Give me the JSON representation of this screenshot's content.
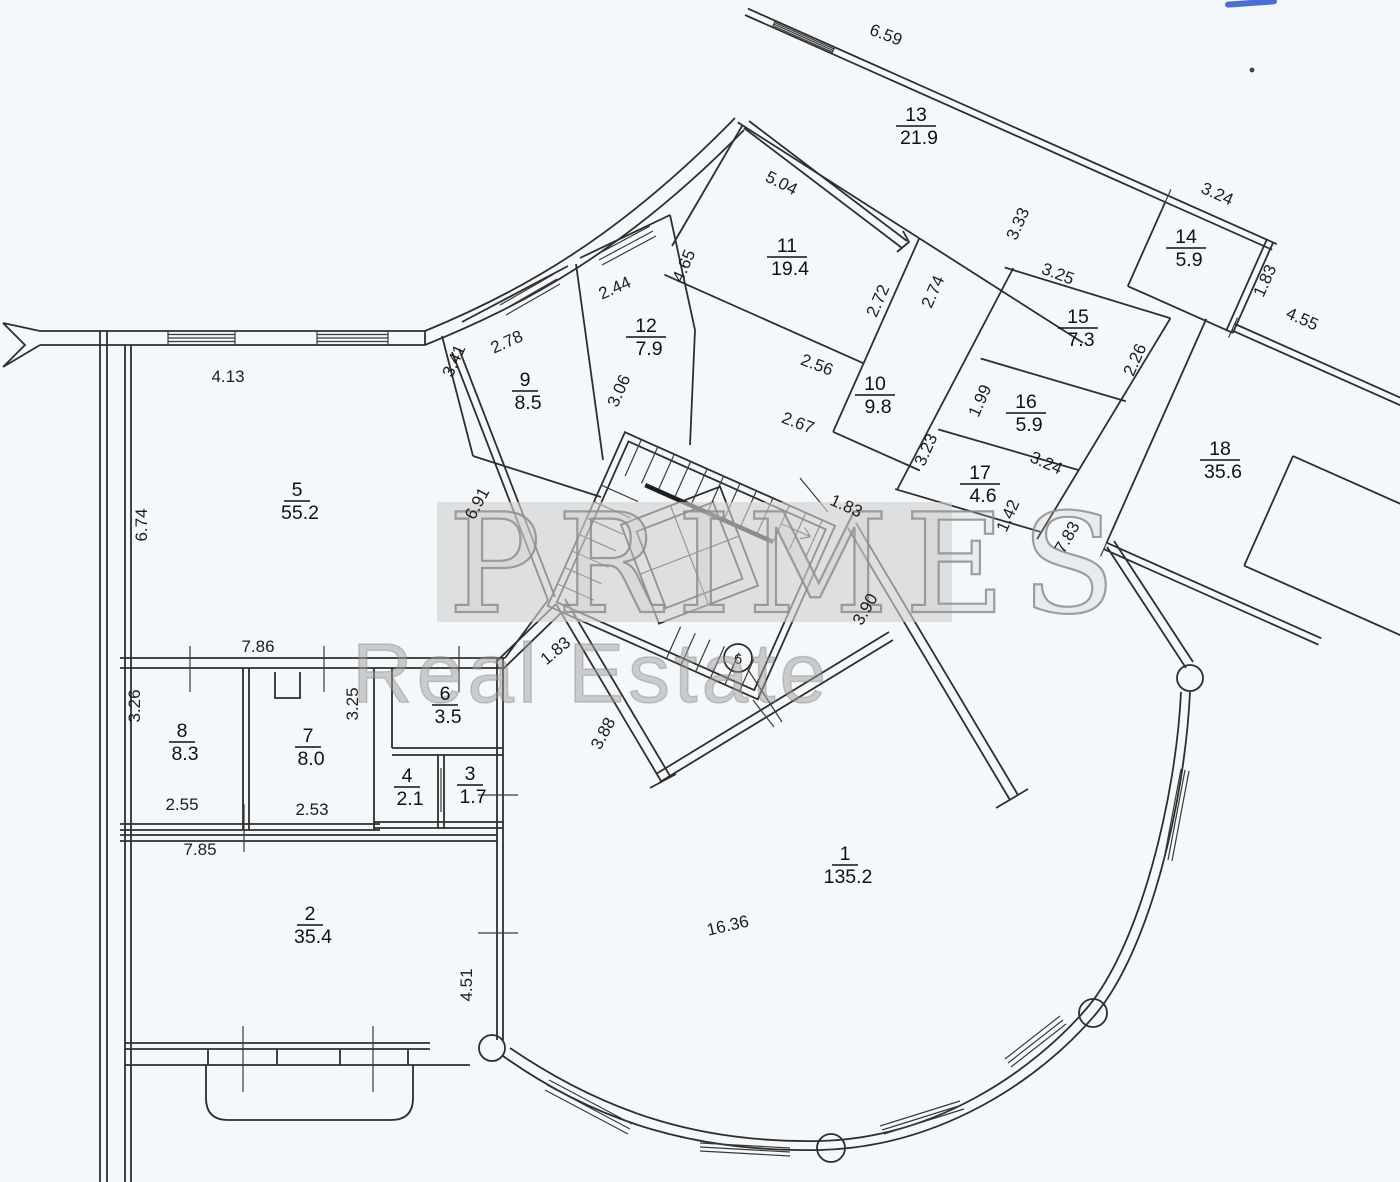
{
  "watermark": {
    "line1": "PRIMES",
    "line2": "Real Estate"
  },
  "column_marker": "6",
  "rooms": [
    {
      "number": "1",
      "area": "135.2",
      "x": 845,
      "y": 860
    },
    {
      "number": "2",
      "area": "35.4",
      "x": 310,
      "y": 920
    },
    {
      "number": "3",
      "area": "1.7",
      "x": 470,
      "y": 780
    },
    {
      "number": "4",
      "area": "2.1",
      "x": 407,
      "y": 782
    },
    {
      "number": "5",
      "area": "55.2",
      "x": 297,
      "y": 496
    },
    {
      "number": "6",
      "area": "3.5",
      "x": 445,
      "y": 700
    },
    {
      "number": "7",
      "area": "8.0",
      "x": 308,
      "y": 742
    },
    {
      "number": "8",
      "area": "8.3",
      "x": 182,
      "y": 737
    },
    {
      "number": "9",
      "area": "8.5",
      "x": 525,
      "y": 386
    },
    {
      "number": "10",
      "area": "9.8",
      "x": 875,
      "y": 390
    },
    {
      "number": "11",
      "area": "19.4",
      "x": 787,
      "y": 252
    },
    {
      "number": "12",
      "area": "7.9",
      "x": 646,
      "y": 332
    },
    {
      "number": "13",
      "area": "21.9",
      "x": 916,
      "y": 121
    },
    {
      "number": "14",
      "area": "5.9",
      "x": 1186,
      "y": 243
    },
    {
      "number": "15",
      "area": "7.3",
      "x": 1078,
      "y": 323
    },
    {
      "number": "16",
      "area": "5.9",
      "x": 1026,
      "y": 408
    },
    {
      "number": "17",
      "area": "4.6",
      "x": 980,
      "y": 479
    },
    {
      "number": "18",
      "area": "35.6",
      "x": 1220,
      "y": 455
    }
  ],
  "dimensions": [
    {
      "text": "4.13",
      "x": 228,
      "y": 382,
      "rot": 0
    },
    {
      "text": "6.74",
      "x": 147,
      "y": 525,
      "rot": -90
    },
    {
      "text": "7.86",
      "x": 258,
      "y": 652,
      "rot": 0
    },
    {
      "text": "3.26",
      "x": 140,
      "y": 706,
      "rot": -90
    },
    {
      "text": "2.55",
      "x": 182,
      "y": 810,
      "rot": 0
    },
    {
      "text": "3.25",
      "x": 358,
      "y": 704,
      "rot": -90
    },
    {
      "text": "2.53",
      "x": 312,
      "y": 815,
      "rot": 0
    },
    {
      "text": "7.85",
      "x": 200,
      "y": 855,
      "rot": 0
    },
    {
      "text": "4.51",
      "x": 472,
      "y": 985,
      "rot": -90
    },
    {
      "text": "16.36",
      "x": 729,
      "y": 931,
      "rot": -13
    },
    {
      "text": "6.59",
      "x": 884,
      "y": 40,
      "rot": 21
    },
    {
      "text": "5.04",
      "x": 779,
      "y": 188,
      "rot": 27
    },
    {
      "text": "3.33",
      "x": 1023,
      "y": 226,
      "rot": -66
    },
    {
      "text": "3.24",
      "x": 1215,
      "y": 199,
      "rot": 24
    },
    {
      "text": "1.83",
      "x": 1270,
      "y": 283,
      "rot": -66
    },
    {
      "text": "4.55",
      "x": 1300,
      "y": 324,
      "rot": 24
    },
    {
      "text": "3.25",
      "x": 1056,
      "y": 279,
      "rot": 21
    },
    {
      "text": "2.26",
      "x": 1140,
      "y": 362,
      "rot": -66
    },
    {
      "text": "2.72",
      "x": 883,
      "y": 303,
      "rot": -66
    },
    {
      "text": "2.74",
      "x": 938,
      "y": 294,
      "rot": -66
    },
    {
      "text": "2.56",
      "x": 815,
      "y": 370,
      "rot": 21
    },
    {
      "text": "2.67",
      "x": 796,
      "y": 428,
      "rot": 21
    },
    {
      "text": "1.99",
      "x": 985,
      "y": 403,
      "rot": -66
    },
    {
      "text": "3.23",
      "x": 931,
      "y": 452,
      "rot": -66
    },
    {
      "text": "3.24",
      "x": 1044,
      "y": 468,
      "rot": 24
    },
    {
      "text": "1.42",
      "x": 1013,
      "y": 518,
      "rot": -66
    },
    {
      "text": "7.83",
      "x": 1072,
      "y": 540,
      "rot": -60
    },
    {
      "text": "2.44",
      "x": 617,
      "y": 293,
      "rot": -24
    },
    {
      "text": "4.65",
      "x": 689,
      "y": 268,
      "rot": -66
    },
    {
      "text": "3.06",
      "x": 624,
      "y": 393,
      "rot": -66
    },
    {
      "text": "2.78",
      "x": 509,
      "y": 347,
      "rot": -24
    },
    {
      "text": "3.41",
      "x": 459,
      "y": 363,
      "rot": -66
    },
    {
      "text": "6.91",
      "x": 482,
      "y": 506,
      "rot": -62
    },
    {
      "text": "1.83",
      "x": 559,
      "y": 655,
      "rot": -40
    },
    {
      "text": "3.88",
      "x": 608,
      "y": 736,
      "rot": -62
    },
    {
      "text": "1.83",
      "x": 844,
      "y": 511,
      "rot": 24
    },
    {
      "text": "3.90",
      "x": 870,
      "y": 612,
      "rot": -60
    }
  ]
}
